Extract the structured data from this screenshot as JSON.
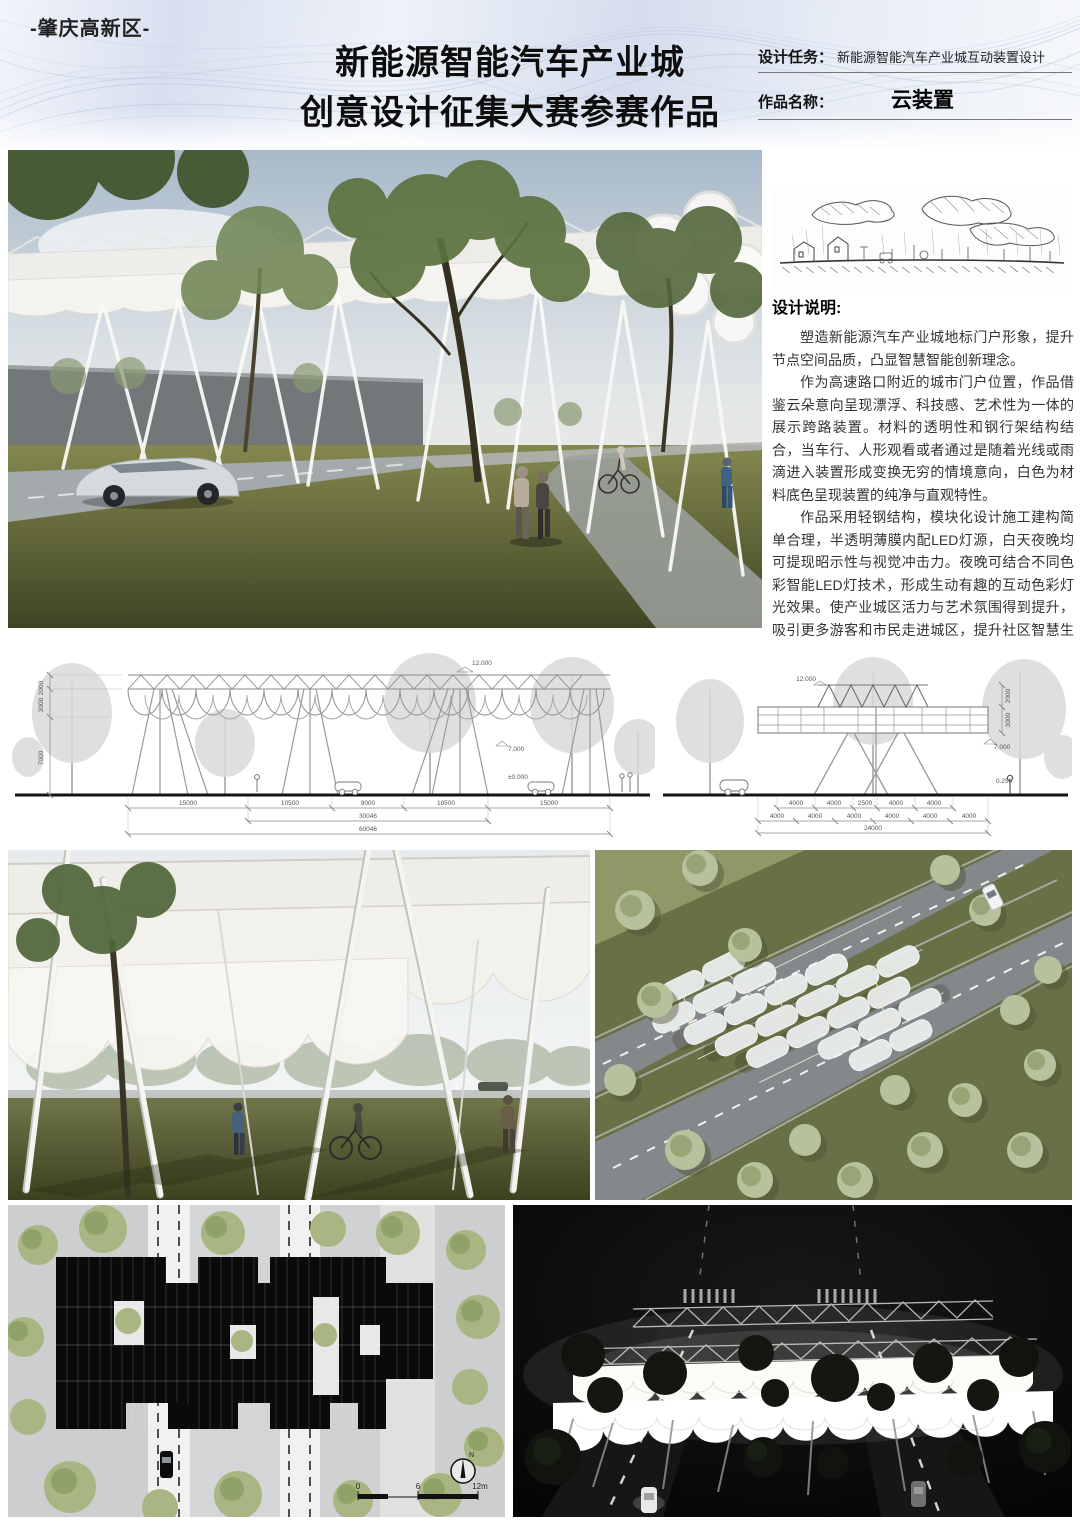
{
  "header": {
    "badge": "-肇庆高新区-",
    "title_line1": "新能源智能汽车产业城",
    "title_line2": "创意设计征集大赛参赛作品",
    "task_label": "设计任务：",
    "task_value": "新能源智能汽车产业城互动装置设计",
    "name_label": "作品名称：",
    "name_value": "云装置"
  },
  "description": {
    "title": "设计说明:",
    "p1": "塑造新能源汽车产业城地标门户形象，提升节点空间品质，凸显智慧智能创新理念。",
    "p2": "作为高速路口附近的城市门户位置，作品借鉴云朵意向呈现漂浮、科技感、艺术性为一体的展示跨路装置。材料的透明性和钢行架结构结合，当车行、人形观看或者通过是随着光线或雨滴进入装置形成变换无穷的情境意向，白色为材料底色呈现装置的纯净与直观特性。",
    "p3": "作品采用轻钢结构，模块化设计施工建构简单合理，半透明薄膜内配LED灯源，白天夜晚均可提现昭示性与视觉冲击力。夜晚可结合不同色彩智能LED灯技术，形成生动有趣的互动色彩灯光效果。使产业城区活力与艺术氛围得到提升，吸引更多游客和市民走进城区，提升社区智慧生活。"
  },
  "elevation_left": {
    "top_dim": "12.000",
    "mid_dim": "7.000",
    "ground_dim": "±0.000",
    "v1": "2000",
    "v2": "3000",
    "v3": "7000",
    "d1": "15000",
    "d2": "10500",
    "d3": "9000",
    "d4": "10500",
    "d5": "15000",
    "sub_total": "30046",
    "total": "60046"
  },
  "elevation_right": {
    "top_dim": "12.000",
    "mid_dim": "7.000",
    "ground_dim": "0.250",
    "v1": "2000",
    "v2": "3000",
    "a1": "4000",
    "a2": "4000",
    "a3": "2500",
    "a4": "4000",
    "a5": "4000",
    "b1": "4000",
    "b2": "4000",
    "b3": "4000",
    "b4": "4000",
    "b5": "4000",
    "b6": "4000",
    "total": "24000"
  },
  "plan": {
    "scale_0": "0",
    "scale_mid": "6",
    "scale_end": "12m",
    "north": "N"
  },
  "colors": {
    "band_blue": "#d8e0f0",
    "canopy_white": "#f4f3ef",
    "grass_green": "#6b7143",
    "plan_gray": "#d6d7d8",
    "night_bg": "#070707"
  }
}
